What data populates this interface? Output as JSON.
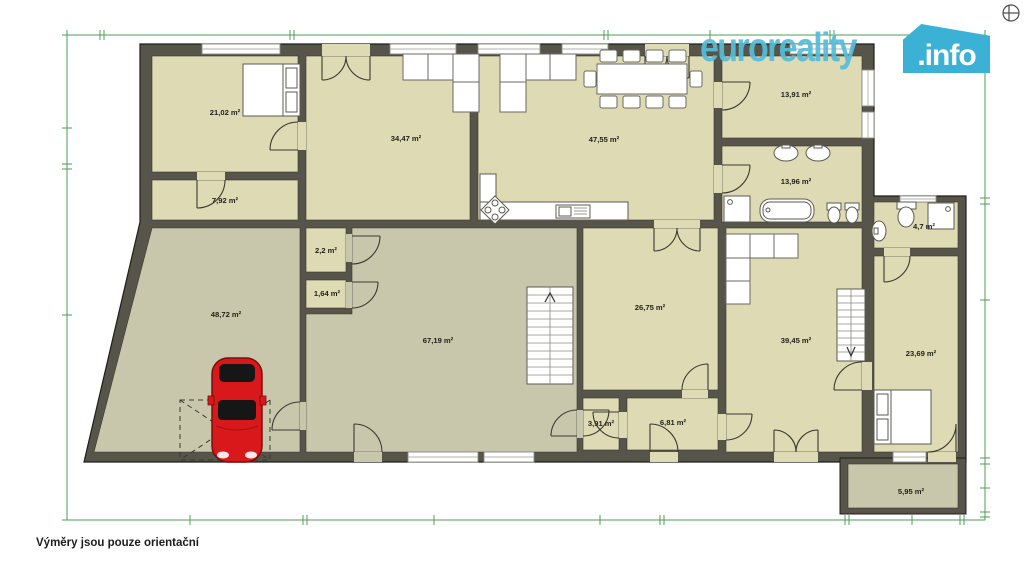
{
  "logo": {
    "brand": "euroreality",
    "tld": ".info",
    "brand_color": "#54bcd9",
    "badge_color": "#3bb1d6",
    "tld_color": "#ffffff"
  },
  "footer": {
    "note": "Výměry jsou pouze orientační"
  },
  "colors": {
    "room_fill": "#dedab4",
    "hall_fill": "#c9c7ab",
    "wall": "#57544a",
    "dimension_green": "#4d9d57",
    "car_red": "#d8181a"
  },
  "rooms": [
    {
      "label": "21,02 m²"
    },
    {
      "label": "7,92 m²"
    },
    {
      "label": "34,47 m²"
    },
    {
      "label": "47,55 m²"
    },
    {
      "label": "13,91 m²"
    },
    {
      "label": "13,96 m²"
    },
    {
      "label": "4,7 m²"
    },
    {
      "label": "2,2 m²"
    },
    {
      "label": "1,64 m²"
    },
    {
      "label": "48,72 m²"
    },
    {
      "label": "67,19 m²"
    },
    {
      "label": "26,75 m²"
    },
    {
      "label": "39,45 m²"
    },
    {
      "label": "23,69 m²"
    },
    {
      "label": "3,91 m²"
    },
    {
      "label": "6,81 m²"
    },
    {
      "label": "5,95 m²"
    }
  ]
}
